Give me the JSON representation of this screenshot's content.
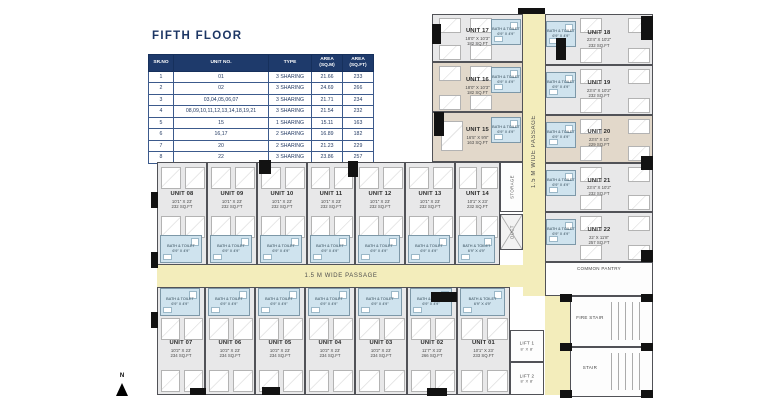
{
  "title": "FIFTH FLOOR",
  "colors": {
    "accent_navy": "#1e3a6b",
    "room_gray": "#e8e8e9",
    "room_beige": "#e2d8ca",
    "bath_blue": "#cfe3ee",
    "passage_yellow": "#f3edbb",
    "wall": "#515257"
  },
  "table": {
    "headers": [
      "SR.NO",
      "UNIT NO.",
      "TYPE",
      "AREA\n(SQ.M)",
      "AREA\n(SQ.FT)"
    ],
    "rows": [
      [
        "1",
        "01",
        "3 SHARING",
        "21.66",
        "233"
      ],
      [
        "2",
        "02",
        "3 SHARING",
        "24.69",
        "266"
      ],
      [
        "3",
        "03,04,05,06,07",
        "3 SHARING",
        "21.71",
        "234"
      ],
      [
        "4",
        "08,09,10,11,12,13,14,18,19,21",
        "3 SHARING",
        "21.54",
        "232"
      ],
      [
        "5",
        "15",
        "1 SHARING",
        "15.11",
        "163"
      ],
      [
        "6",
        "16,17",
        "2 SHARING",
        "16.89",
        "182"
      ],
      [
        "7",
        "20",
        "2 SHARING",
        "21.23",
        "229"
      ],
      [
        "8",
        "22",
        "3 SHARING",
        "23.86",
        "257"
      ]
    ]
  },
  "plan": {
    "passage_label": "1.5 M WIDE PASSAGE",
    "north_label": "N",
    "bath": {
      "label": "BATH & TOILET",
      "dims": "6'9\" X 4'9\""
    },
    "units": [
      {
        "id": "01",
        "name": "UNIT 01",
        "dims": "10'1\" X 23'",
        "area": "233 SQ.FT",
        "x": 457,
        "y": 287,
        "w": 53,
        "h": 108,
        "floor": "gray",
        "beds": "up",
        "bath": "top"
      },
      {
        "id": "02",
        "name": "UNIT 02",
        "dims": "11'7\" X 23'",
        "area": "266 SQ.FT",
        "x": 407,
        "y": 287,
        "w": 50,
        "h": 108,
        "floor": "gray",
        "beds": "up",
        "bath": "top"
      },
      {
        "id": "03",
        "name": "UNIT 03",
        "dims": "10'2\" X 23'",
        "area": "234 SQ.FT",
        "x": 355,
        "y": 287,
        "w": 52,
        "h": 108,
        "floor": "gray",
        "beds": "up",
        "bath": "top"
      },
      {
        "id": "04",
        "name": "UNIT 04",
        "dims": "10'2\" X 23'",
        "area": "234 SQ.FT",
        "x": 305,
        "y": 287,
        "w": 50,
        "h": 108,
        "floor": "gray",
        "beds": "up",
        "bath": "top"
      },
      {
        "id": "05",
        "name": "UNIT 05",
        "dims": "10'2\" X 23'",
        "area": "234 SQ.FT",
        "x": 255,
        "y": 287,
        "w": 50,
        "h": 108,
        "floor": "gray",
        "beds": "up",
        "bath": "top"
      },
      {
        "id": "06",
        "name": "UNIT 06",
        "dims": "10'2\" X 23'",
        "area": "234 SQ.FT",
        "x": 205,
        "y": 287,
        "w": 50,
        "h": 108,
        "floor": "gray",
        "beds": "up",
        "bath": "top"
      },
      {
        "id": "07",
        "name": "UNIT 07",
        "dims": "10'2\" X 23'",
        "area": "234 SQ.FT",
        "x": 157,
        "y": 287,
        "w": 48,
        "h": 108,
        "floor": "gray",
        "beds": "up",
        "bath": "top"
      },
      {
        "id": "08",
        "name": "UNIT 08",
        "dims": "10'1\" X 23'",
        "area": "232 SQ.FT",
        "x": 157,
        "y": 162,
        "w": 50,
        "h": 103,
        "floor": "gray",
        "beds": "down",
        "bath": "bottom"
      },
      {
        "id": "09",
        "name": "UNIT 09",
        "dims": "10'1\" X 23'",
        "area": "232 SQ.FT",
        "x": 207,
        "y": 162,
        "w": 50,
        "h": 103,
        "floor": "gray",
        "beds": "down",
        "bath": "bottom"
      },
      {
        "id": "10",
        "name": "UNIT 10",
        "dims": "10'1\" X 23'",
        "area": "232 SQ.FT",
        "x": 257,
        "y": 162,
        "w": 50,
        "h": 103,
        "floor": "gray",
        "beds": "down",
        "bath": "bottom"
      },
      {
        "id": "11",
        "name": "UNIT 11",
        "dims": "10'1\" X 23'",
        "area": "232 SQ.FT",
        "x": 307,
        "y": 162,
        "w": 48,
        "h": 103,
        "floor": "gray",
        "beds": "down",
        "bath": "bottom"
      },
      {
        "id": "12",
        "name": "UNIT 12",
        "dims": "10'1\" X 23'",
        "area": "232 SQ.FT",
        "x": 355,
        "y": 162,
        "w": 50,
        "h": 103,
        "floor": "gray",
        "beds": "down",
        "bath": "bottom"
      },
      {
        "id": "13",
        "name": "UNIT 13",
        "dims": "10'1\" X 23'",
        "area": "232 SQ.FT",
        "x": 405,
        "y": 162,
        "w": 50,
        "h": 103,
        "floor": "gray",
        "beds": "down",
        "bath": "bottom"
      },
      {
        "id": "14",
        "name": "UNIT 14",
        "dims": "10'1\" X 23'",
        "area": "232 SQ.FT",
        "x": 455,
        "y": 162,
        "w": 45,
        "h": 103,
        "floor": "gray",
        "beds": "down",
        "bath": "bottom"
      },
      {
        "id": "15",
        "name": "UNIT 15",
        "dims": "16'5\" X 9'8\"",
        "area": "163 SQ.FT",
        "x": 432,
        "y": 112,
        "w": 91,
        "h": 50,
        "floor": "beige",
        "beds": "one",
        "bath": "right"
      },
      {
        "id": "16",
        "name": "UNIT 16",
        "dims": "18'0\" X 10'3\"",
        "area": "182 SQ.FT",
        "x": 432,
        "y": 62,
        "w": 91,
        "h": 50,
        "floor": "beige",
        "beds": "wide",
        "bath": "right"
      },
      {
        "id": "17",
        "name": "UNIT 17",
        "dims": "18'0\" X 10'3\"",
        "area": "182 SQ.FT",
        "x": 432,
        "y": 14,
        "w": 91,
        "h": 48,
        "floor": "gray",
        "beds": "wide",
        "bath": "right"
      },
      {
        "id": "18",
        "name": "UNIT 18",
        "dims": "23'4\" X 10'2\"",
        "area": "232 SQ.FT",
        "x": 545,
        "y": 14,
        "w": 108,
        "h": 51,
        "floor": "gray",
        "beds": "wide",
        "bath": "left"
      },
      {
        "id": "19",
        "name": "UNIT 19",
        "dims": "23'4\" X 10'2\"",
        "area": "232 SQ.FT",
        "x": 545,
        "y": 65,
        "w": 108,
        "h": 50,
        "floor": "gray",
        "beds": "wide",
        "bath": "left"
      },
      {
        "id": "20",
        "name": "UNIT 20",
        "dims": "23'4\" X 10'",
        "area": "229 SQ.FT",
        "x": 545,
        "y": 115,
        "w": 108,
        "h": 48,
        "floor": "beige",
        "beds": "wide",
        "bath": "left"
      },
      {
        "id": "21",
        "name": "UNIT 21",
        "dims": "23'4\" X 10'2\"",
        "area": "232 SQ.FT",
        "x": 545,
        "y": 163,
        "w": 108,
        "h": 49,
        "floor": "gray",
        "beds": "wide",
        "bath": "left"
      },
      {
        "id": "22",
        "name": "UNIT 22",
        "dims": "22' X 11'8\"",
        "area": "257 SQ.FT",
        "x": 545,
        "y": 212,
        "w": 108,
        "h": 50,
        "floor": "gray",
        "beds": "wide",
        "bath": "left"
      }
    ],
    "service": [
      {
        "name": "STORAGE",
        "x": 500,
        "y": 162,
        "w": 23,
        "h": 50,
        "vertical": true
      },
      {
        "name": "DUCT",
        "x": 500,
        "y": 214,
        "w": 23,
        "h": 36,
        "vertical": true,
        "cross": true
      },
      {
        "name": "COMMON PANTRY",
        "x": 545,
        "y": 262,
        "w": 108,
        "h": 34,
        "lpos": "top"
      },
      {
        "name": "FIRE STAIR",
        "x": 570,
        "y": 296,
        "w": 83,
        "h": 51,
        "stairs": true
      },
      {
        "name": "STAIR",
        "x": 570,
        "y": 347,
        "w": 83,
        "h": 50,
        "stairs": true
      },
      {
        "name": "LIFT 1",
        "dims": "8' X 8'",
        "x": 510,
        "y": 330,
        "w": 34,
        "h": 32
      },
      {
        "name": "LIFT 2",
        "dims": "8' X 8'",
        "x": 510,
        "y": 362,
        "w": 34,
        "h": 33
      }
    ],
    "passages": [
      {
        "x": 523,
        "y": 8,
        "w": 22,
        "h": 288,
        "vertical": true,
        "label": true
      },
      {
        "x": 157,
        "y": 265,
        "w": 368,
        "h": 22,
        "label": true
      },
      {
        "x": 545,
        "y": 296,
        "w": 25,
        "h": 99
      }
    ],
    "columns": [
      [
        432,
        24,
        9,
        20
      ],
      [
        518,
        8,
        27,
        6
      ],
      [
        556,
        38,
        10,
        22
      ],
      [
        641,
        16,
        12,
        24
      ],
      [
        434,
        112,
        10,
        24
      ],
      [
        641,
        156,
        12,
        14
      ],
      [
        641,
        250,
        12,
        12
      ],
      [
        259,
        160,
        12,
        14
      ],
      [
        348,
        161,
        10,
        16
      ],
      [
        151,
        192,
        7,
        16
      ],
      [
        151,
        252,
        7,
        16
      ],
      [
        151,
        312,
        7,
        16
      ],
      [
        431,
        292,
        26,
        10
      ],
      [
        190,
        388,
        16,
        7
      ],
      [
        262,
        387,
        18,
        8
      ],
      [
        427,
        388,
        20,
        8
      ],
      [
        560,
        294,
        12,
        8
      ],
      [
        641,
        294,
        12,
        8
      ],
      [
        560,
        343,
        12,
        8
      ],
      [
        641,
        343,
        12,
        8
      ],
      [
        560,
        390,
        12,
        8
      ],
      [
        641,
        390,
        12,
        8
      ]
    ]
  }
}
